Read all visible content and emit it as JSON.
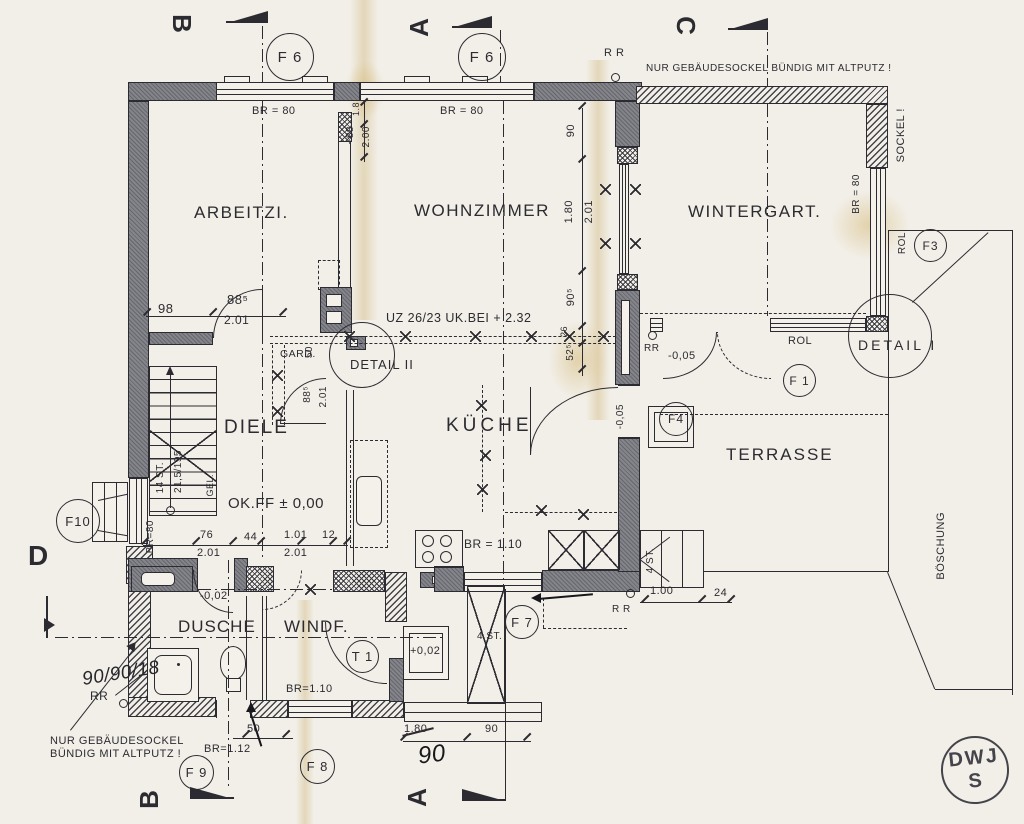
{
  "rooms": {
    "arbeitszimmer": "ARBEITZI.",
    "wohnzimmer": "WOHNZIMMER",
    "wintergarten": "WINTERGART.",
    "diele": "DIELE",
    "kueche": "KÜCHE",
    "terrasse": "TERRASSE",
    "dusche": "DUSCHE",
    "windfang": "WINDF."
  },
  "markers": {
    "f6a": "F 6",
    "f6b": "F 6",
    "f3": "F3",
    "f1": "F 1",
    "f4": "F4",
    "f7": "F 7",
    "f8": "F 8",
    "f9": "F 9",
    "f10": "F10",
    "t1": "T 1"
  },
  "details": {
    "detail1": "DETAIL I",
    "detail2": "DETAIL II"
  },
  "sections": {
    "b_top": "B",
    "a_top": "A",
    "c_top": "C",
    "d_left": "D",
    "b_bottom": "B",
    "a_bottom": "A"
  },
  "notes": {
    "sockel_top": "NUR GEBÄUDESOCKEL BÜNDIG MIT ALTPUTZ !",
    "sockel_left1": "NUR GEBÄUDESOCKEL",
    "sockel_left2": "BÜNDIG MIT ALTPUTZ !",
    "sockel_right": "SOCKEL !",
    "boeschung": "BÖSCHUNG",
    "beam": "UZ 26/23 UK.BEI + 2.32",
    "okff": "OK.FF ± 0,00",
    "gard": "GARD.",
    "gel": "GEL.",
    "stairs_count": "14 ST.",
    "stairs_dim": "21,5/195",
    "steps_windfang": "4 ST.",
    "steps_terrasse": "4 ST.",
    "rol_terrasse": "ROL",
    "rol_f3": "ROL"
  },
  "dims": {
    "d98": "98",
    "d885": "88⁵",
    "d201a": "2.01",
    "d18": "1.8",
    "d88t": "~88",
    "d200": "2.00",
    "br80_a": "BR = 80",
    "br80_b": "BR = 80",
    "br80_wg": "BR = 80",
    "br80_diele": "BR=80",
    "d90": "90",
    "d180": "1.80",
    "d201b": "2.01",
    "d905": "90⁵",
    "d26": "26",
    "d525": "52⁵",
    "m005a": "-0,05",
    "m005b": "-0,05",
    "m002": "-0,02",
    "d76": "76",
    "d201c": "2.01",
    "d44": "44",
    "d101": "1.01",
    "d201d": "2.01",
    "d12": "12",
    "d885v": "88⁵",
    "d201e": "2.01",
    "d50v": "50",
    "br110_k": "BR = 1.10",
    "br110_w": "BR=1.10",
    "br112": "BR=1.12",
    "p002": "+0,02",
    "d50": "50",
    "d180x": "1.80",
    "d90p": "90",
    "d100": "1.00",
    "d24": "24",
    "rr_a": "R R",
    "rr_b": "RR",
    "rr_c": "RR",
    "rr_d": "R R"
  },
  "handwritten": {
    "shower": "90/90/18",
    "ninety": "90"
  },
  "stamp": {
    "line1": "DWJ",
    "line2": "S"
  }
}
